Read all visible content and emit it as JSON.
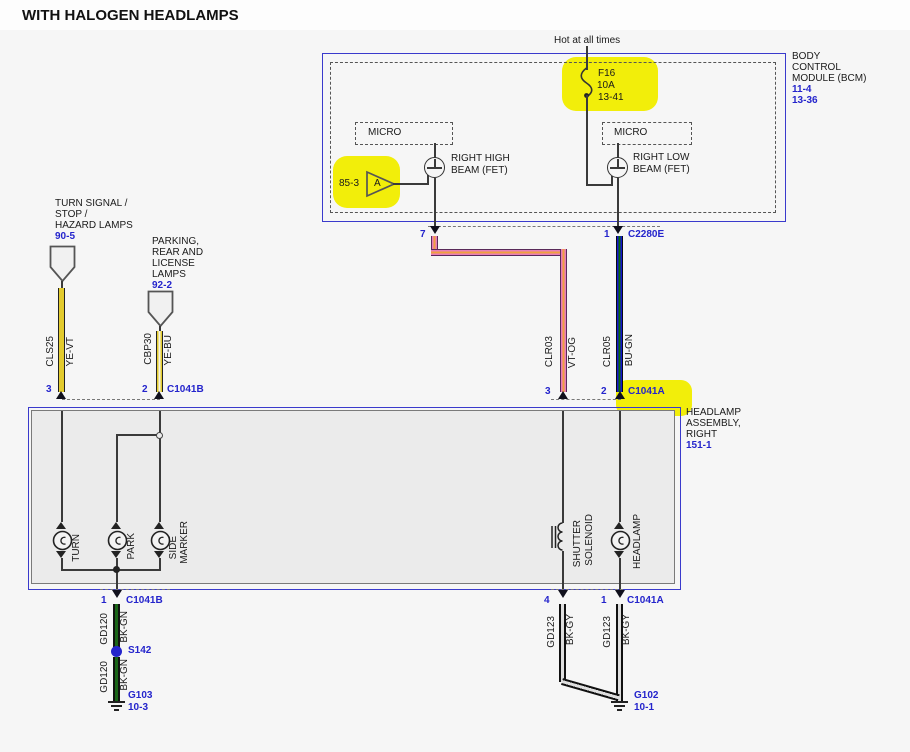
{
  "title": "WITH HALOGEN HEADLAMPS",
  "bcm": {
    "hot_label": "Hot at all times",
    "fuse": {
      "name": "F16",
      "amps": "10A",
      "page": "13-41"
    },
    "title_lines": [
      "BODY",
      "CONTROL",
      "MODULE (BCM)"
    ],
    "page_refs": [
      "11-4",
      "13-36"
    ],
    "micro_label": "MICRO",
    "fet_high": {
      "line1": "RIGHT HIGH",
      "line2": "BEAM (FET)"
    },
    "fet_low": {
      "line1": "RIGHT LOW",
      "line2": "BEAM (FET)"
    },
    "input_a": {
      "page": "85-3",
      "letter": "A"
    }
  },
  "offpage": {
    "turn": {
      "lines": [
        "TURN SIGNAL /",
        "STOP /",
        "HAZARD LAMPS"
      ],
      "page": "90-5"
    },
    "park": {
      "lines": [
        "PARKING,",
        "REAR AND",
        "LICENSE",
        "LAMPS"
      ],
      "page": "92-2"
    }
  },
  "wires": {
    "cls25": {
      "circuit": "CLS25",
      "color": "YE-VT"
    },
    "cbp30": {
      "circuit": "CBP30",
      "color": "YE-BU"
    },
    "clr03": {
      "circuit": "CLR03",
      "color": "VT-OG"
    },
    "clr05": {
      "circuit": "CLR05",
      "color": "BU-GN"
    },
    "gd120": {
      "circuit": "GD120",
      "color": "BK-GN"
    },
    "gd123": {
      "circuit": "GD123",
      "color": "BK-GY"
    }
  },
  "connectors": {
    "c2280e": {
      "name": "C2280E",
      "pin_high": "7",
      "pin_low": "1"
    },
    "c1041b_top": {
      "name": "C1041B",
      "pin_turn": "3",
      "pin_park": "2"
    },
    "c1041a_top": {
      "name": "C1041A",
      "pin_shutter": "3",
      "pin_headlamp": "2"
    },
    "c1041b_bottom": {
      "name": "C1041B",
      "pin": "1"
    },
    "c1041a_bottom": {
      "name": "C1041A",
      "pin_shutter": "4",
      "pin_headlamp": "1"
    }
  },
  "assembly": {
    "title_lines": [
      "HEADLAMP",
      "ASSEMBLY,",
      "RIGHT"
    ],
    "page": "151-1",
    "labels": {
      "turn": "TURN",
      "park": "PARK",
      "side1": "SIDE",
      "side2": "MARKER",
      "shutter1": "SHUTTER",
      "shutter2": "SOLENOID",
      "headlamp": "HEADLAMP"
    }
  },
  "splice": {
    "name": "S142"
  },
  "grounds": {
    "g103": {
      "name": "G103",
      "page": "10-3"
    },
    "g102": {
      "name": "G102",
      "page": "10-1"
    }
  }
}
